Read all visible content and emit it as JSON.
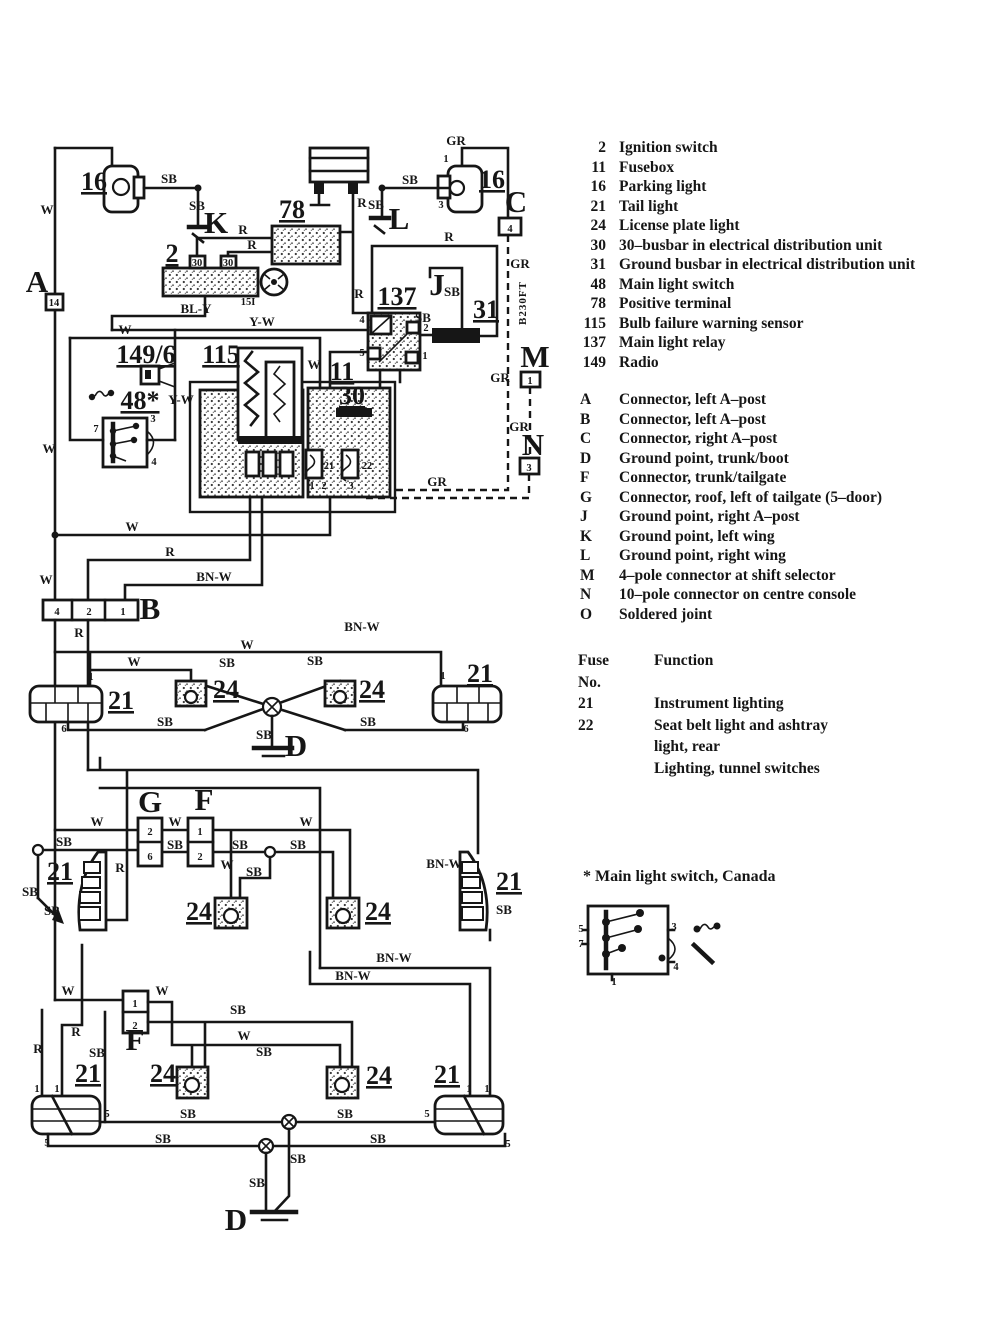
{
  "colors": {
    "ink": "#161616",
    "paper": "#ffffff"
  },
  "legend": {
    "components": [
      {
        "num": "2",
        "name": "Ignition switch"
      },
      {
        "num": "11",
        "name": "Fusebox"
      },
      {
        "num": "16",
        "name": "Parking light"
      },
      {
        "num": "21",
        "name": "Tail light"
      },
      {
        "num": "24",
        "name": "License plate light"
      },
      {
        "num": "30",
        "name": "30–busbar in electrical distribution unit"
      },
      {
        "num": "31",
        "name": "Ground busbar in electrical distribution unit"
      },
      {
        "num": "48",
        "name": "Main light switch"
      },
      {
        "num": "78",
        "name": "Positive terminal"
      },
      {
        "num": "115",
        "name": "Bulb failure warning sensor"
      },
      {
        "num": "137",
        "name": "Main light relay"
      },
      {
        "num": "149",
        "name": "Radio"
      }
    ],
    "connectors": [
      {
        "id": "A",
        "name": "Connector, left A–post"
      },
      {
        "id": "B",
        "name": "Connector, left A–post"
      },
      {
        "id": "C",
        "name": "Connector, right A–post"
      },
      {
        "id": "D",
        "name": "Ground point, trunk/boot"
      },
      {
        "id": "F",
        "name": "Connector, trunk/tailgate"
      },
      {
        "id": "G",
        "name": "Connector, roof, left of tailgate (5–door)"
      },
      {
        "id": "J",
        "name": "Ground point, right A–post"
      },
      {
        "id": "K",
        "name": "Ground point, left wing"
      },
      {
        "id": "L",
        "name": "Ground point, right wing"
      },
      {
        "id": "M",
        "name": "4–pole connector at shift selector"
      },
      {
        "id": "N",
        "name": "10–pole connector on centre console"
      },
      {
        "id": "O",
        "name": "Soldered joint"
      }
    ],
    "fuse_table": {
      "col_fuse": "Fuse",
      "col_no": "No.",
      "col_function": "Function",
      "rows": [
        {
          "no": "21",
          "function": [
            "Instrument lighting"
          ]
        },
        {
          "no": "22",
          "function": [
            "Seat belt light and ashtray",
            "light, rear",
            "Lighting, tunnel switches"
          ]
        }
      ]
    },
    "footnote": "* Main light switch, Canada"
  },
  "diagram": {
    "labels": [
      {
        "t": "16",
        "x": 94,
        "y": 190,
        "c": "comp"
      },
      {
        "t": "SB",
        "x": 169,
        "y": 183
      },
      {
        "t": "SB",
        "x": 197,
        "y": 210
      },
      {
        "t": "K",
        "x": 216,
        "y": 233,
        "c": "letter"
      },
      {
        "t": "W",
        "x": 47,
        "y": 214
      },
      {
        "t": "2",
        "x": 172,
        "y": 262,
        "c": "comp"
      },
      {
        "t": "30",
        "x": 197,
        "y": 266,
        "c": "pin"
      },
      {
        "t": "30",
        "x": 228,
        "y": 266,
        "c": "pin"
      },
      {
        "t": "15I",
        "x": 248,
        "y": 305,
        "c": "pin"
      },
      {
        "t": "BL-Y",
        "x": 196,
        "y": 313
      },
      {
        "t": "R",
        "x": 243,
        "y": 234
      },
      {
        "t": "R",
        "x": 252,
        "y": 249
      },
      {
        "t": "78",
        "x": 292,
        "y": 218,
        "c": "comp"
      },
      {
        "t": "R",
        "x": 362,
        "y": 207
      },
      {
        "t": "R",
        "x": 359,
        "y": 298
      },
      {
        "t": "GR",
        "x": 456,
        "y": 145
      },
      {
        "t": "16",
        "x": 492,
        "y": 188,
        "c": "comp"
      },
      {
        "t": "SB",
        "x": 410,
        "y": 184
      },
      {
        "t": "SB",
        "x": 376,
        "y": 209
      },
      {
        "t": "L",
        "x": 399,
        "y": 229,
        "c": "letter"
      },
      {
        "t": "C",
        "x": 516,
        "y": 212,
        "c": "letter"
      },
      {
        "t": "4",
        "x": 510,
        "y": 232,
        "c": "pin"
      },
      {
        "t": "1",
        "x": 446,
        "y": 162,
        "c": "pin"
      },
      {
        "t": "3",
        "x": 441,
        "y": 208,
        "c": "pin"
      },
      {
        "t": "GR",
        "x": 520,
        "y": 268
      },
      {
        "t": "B230FT",
        "x": 526,
        "y": 303,
        "c": "vert"
      },
      {
        "t": "J",
        "x": 437,
        "y": 295,
        "c": "letter"
      },
      {
        "t": "SB",
        "x": 452,
        "y": 296
      },
      {
        "t": "31",
        "x": 486,
        "y": 318,
        "c": "comp"
      },
      {
        "t": "SB",
        "x": 423,
        "y": 322
      },
      {
        "t": "137",
        "x": 397,
        "y": 305,
        "c": "comp"
      },
      {
        "t": "4",
        "x": 362,
        "y": 323,
        "c": "pin"
      },
      {
        "t": "2",
        "x": 426,
        "y": 331,
        "c": "pin"
      },
      {
        "t": "5",
        "x": 362,
        "y": 356,
        "c": "pin"
      },
      {
        "t": "1",
        "x": 425,
        "y": 359,
        "c": "pin"
      },
      {
        "t": "R",
        "x": 449,
        "y": 241
      },
      {
        "t": "M",
        "x": 535,
        "y": 367,
        "c": "letter"
      },
      {
        "t": "1",
        "x": 530,
        "y": 384,
        "c": "pin"
      },
      {
        "t": "GR",
        "x": 500,
        "y": 382
      },
      {
        "t": "GR",
        "x": 519,
        "y": 431
      },
      {
        "t": "N",
        "x": 533,
        "y": 455,
        "c": "letter"
      },
      {
        "t": "3",
        "x": 529,
        "y": 471,
        "c": "pin"
      },
      {
        "t": "GR",
        "x": 437,
        "y": 486
      },
      {
        "t": "149/6",
        "x": 146,
        "y": 363,
        "c": "comp"
      },
      {
        "t": "48*",
        "x": 140,
        "y": 409,
        "c": "comp"
      },
      {
        "t": "Y-W",
        "x": 181,
        "y": 404
      },
      {
        "t": "Y-W",
        "x": 262,
        "y": 326
      },
      {
        "t": "W",
        "x": 125,
        "y": 334
      },
      {
        "t": "115",
        "x": 221,
        "y": 363,
        "c": "comp"
      },
      {
        "t": "W",
        "x": 314,
        "y": 369
      },
      {
        "t": "11",
        "x": 342,
        "y": 380,
        "c": "comp"
      },
      {
        "t": "30",
        "x": 352,
        "y": 404,
        "c": "comp"
      },
      {
        "t": "21",
        "x": 329,
        "y": 469,
        "c": "pin"
      },
      {
        "t": "22",
        "x": 367,
        "y": 469,
        "c": "pin"
      },
      {
        "t": "1",
        "x": 312,
        "y": 489,
        "c": "pin"
      },
      {
        "t": "2",
        "x": 324,
        "y": 489,
        "c": "pin"
      },
      {
        "t": "3",
        "x": 351,
        "y": 489,
        "c": "pin"
      },
      {
        "t": "7",
        "x": 96,
        "y": 432,
        "c": "pin"
      },
      {
        "t": "3",
        "x": 153,
        "y": 422,
        "c": "pin"
      },
      {
        "t": "4",
        "x": 154,
        "y": 465,
        "c": "pin"
      },
      {
        "t": "A",
        "x": 37,
        "y": 292,
        "c": "letter"
      },
      {
        "t": "14",
        "x": 54,
        "y": 306,
        "c": "pin"
      },
      {
        "t": "W",
        "x": 49,
        "y": 453
      },
      {
        "t": "W",
        "x": 132,
        "y": 531
      },
      {
        "t": "R",
        "x": 170,
        "y": 556
      },
      {
        "t": "W",
        "x": 46,
        "y": 584
      },
      {
        "t": "BN-W",
        "x": 214,
        "y": 581
      },
      {
        "t": "B",
        "x": 150,
        "y": 619,
        "c": "letter"
      },
      {
        "t": "4",
        "x": 57,
        "y": 615,
        "c": "pin"
      },
      {
        "t": "2",
        "x": 89,
        "y": 615,
        "c": "pin"
      },
      {
        "t": "1",
        "x": 123,
        "y": 615,
        "c": "pin"
      },
      {
        "t": "R",
        "x": 79,
        "y": 637
      },
      {
        "t": "BN-W",
        "x": 362,
        "y": 631
      },
      {
        "t": "W",
        "x": 247,
        "y": 649
      },
      {
        "t": "SB",
        "x": 227,
        "y": 667
      },
      {
        "t": "SB",
        "x": 315,
        "y": 665
      },
      {
        "t": "W",
        "x": 134,
        "y": 666
      },
      {
        "t": "21",
        "x": 121,
        "y": 709,
        "c": "comp"
      },
      {
        "t": "1",
        "x": 91,
        "y": 680,
        "c": "pin"
      },
      {
        "t": "6",
        "x": 64,
        "y": 732,
        "c": "pin"
      },
      {
        "t": "24",
        "x": 226,
        "y": 698,
        "c": "comp"
      },
      {
        "t": "24",
        "x": 372,
        "y": 698,
        "c": "comp"
      },
      {
        "t": "21",
        "x": 480,
        "y": 682,
        "c": "comp"
      },
      {
        "t": "1",
        "x": 443,
        "y": 679,
        "c": "pin"
      },
      {
        "t": "6",
        "x": 466,
        "y": 732,
        "c": "pin"
      },
      {
        "t": "SB",
        "x": 165,
        "y": 726
      },
      {
        "t": "SB",
        "x": 368,
        "y": 726
      },
      {
        "t": "SB",
        "x": 264,
        "y": 739
      },
      {
        "t": "D",
        "x": 296,
        "y": 756,
        "c": "letter"
      },
      {
        "t": "G",
        "x": 150,
        "y": 812,
        "c": "letter"
      },
      {
        "t": "F",
        "x": 204,
        "y": 810,
        "c": "letter"
      },
      {
        "t": "2",
        "x": 150,
        "y": 835,
        "c": "pin"
      },
      {
        "t": "6",
        "x": 150,
        "y": 860,
        "c": "pin"
      },
      {
        "t": "1",
        "x": 200,
        "y": 835,
        "c": "pin"
      },
      {
        "t": "2",
        "x": 200,
        "y": 860,
        "c": "pin"
      },
      {
        "t": "W",
        "x": 97,
        "y": 826
      },
      {
        "t": "W",
        "x": 175,
        "y": 826
      },
      {
        "t": "W",
        "x": 306,
        "y": 826
      },
      {
        "t": "SB",
        "x": 64,
        "y": 846
      },
      {
        "t": "SB",
        "x": 175,
        "y": 849
      },
      {
        "t": "SB",
        "x": 240,
        "y": 849
      },
      {
        "t": "SB",
        "x": 298,
        "y": 849
      },
      {
        "t": "W",
        "x": 227,
        "y": 869
      },
      {
        "t": "SB",
        "x": 254,
        "y": 876
      },
      {
        "t": "21",
        "x": 60,
        "y": 880,
        "c": "comp"
      },
      {
        "t": "SB",
        "x": 30,
        "y": 896
      },
      {
        "t": "SB",
        "x": 52,
        "y": 915
      },
      {
        "t": "R",
        "x": 120,
        "y": 872
      },
      {
        "t": "24",
        "x": 199,
        "y": 920,
        "c": "comp"
      },
      {
        "t": "24",
        "x": 378,
        "y": 920,
        "c": "comp"
      },
      {
        "t": "BN-W",
        "x": 444,
        "y": 868
      },
      {
        "t": "21",
        "x": 509,
        "y": 890,
        "c": "comp"
      },
      {
        "t": "SB",
        "x": 504,
        "y": 914
      },
      {
        "t": "BN-W",
        "x": 394,
        "y": 962
      },
      {
        "t": "BN-W",
        "x": 353,
        "y": 980
      },
      {
        "t": "W",
        "x": 68,
        "y": 995
      },
      {
        "t": "F",
        "x": 135,
        "y": 1050,
        "c": "letter"
      },
      {
        "t": "1",
        "x": 135,
        "y": 1007,
        "c": "pin"
      },
      {
        "t": "2",
        "x": 135,
        "y": 1029,
        "c": "pin"
      },
      {
        "t": "W",
        "x": 162,
        "y": 995
      },
      {
        "t": "SB",
        "x": 238,
        "y": 1014
      },
      {
        "t": "W",
        "x": 244,
        "y": 1040
      },
      {
        "t": "SB",
        "x": 264,
        "y": 1056
      },
      {
        "t": "R",
        "x": 76,
        "y": 1036
      },
      {
        "t": "R",
        "x": 38,
        "y": 1053
      },
      {
        "t": "SB",
        "x": 97,
        "y": 1057
      },
      {
        "t": "21",
        "x": 88,
        "y": 1082,
        "c": "comp"
      },
      {
        "t": "24",
        "x": 163,
        "y": 1082,
        "c": "comp"
      },
      {
        "t": "24",
        "x": 379,
        "y": 1084,
        "c": "comp"
      },
      {
        "t": "21",
        "x": 447,
        "y": 1083,
        "c": "comp"
      },
      {
        "t": "1",
        "x": 37,
        "y": 1092,
        "c": "pin"
      },
      {
        "t": "1",
        "x": 57,
        "y": 1092,
        "c": "pin"
      },
      {
        "t": "1",
        "x": 469,
        "y": 1092,
        "c": "pin"
      },
      {
        "t": "1",
        "x": 487,
        "y": 1092,
        "c": "pin"
      },
      {
        "t": "5",
        "x": 107,
        "y": 1117,
        "c": "pin"
      },
      {
        "t": "5",
        "x": 47,
        "y": 1146,
        "c": "pin"
      },
      {
        "t": "5",
        "x": 427,
        "y": 1117,
        "c": "pin"
      },
      {
        "t": "5",
        "x": 508,
        "y": 1147,
        "c": "pin"
      },
      {
        "t": "SB",
        "x": 188,
        "y": 1118
      },
      {
        "t": "SB",
        "x": 345,
        "y": 1118
      },
      {
        "t": "SB",
        "x": 163,
        "y": 1143
      },
      {
        "t": "SB",
        "x": 378,
        "y": 1143
      },
      {
        "t": "SB",
        "x": 298,
        "y": 1163
      },
      {
        "t": "SB",
        "x": 257,
        "y": 1187
      },
      {
        "t": "D",
        "x": 236,
        "y": 1230,
        "c": "letter"
      },
      {
        "t": "5",
        "x": 581,
        "y": 932,
        "c": "pin"
      },
      {
        "t": "7",
        "x": 581,
        "y": 947,
        "c": "pin"
      },
      {
        "t": "3",
        "x": 674,
        "y": 930,
        "c": "pin"
      },
      {
        "t": "4",
        "x": 676,
        "y": 970,
        "c": "pin"
      },
      {
        "t": "1",
        "x": 614,
        "y": 985,
        "c": "pin"
      }
    ]
  }
}
